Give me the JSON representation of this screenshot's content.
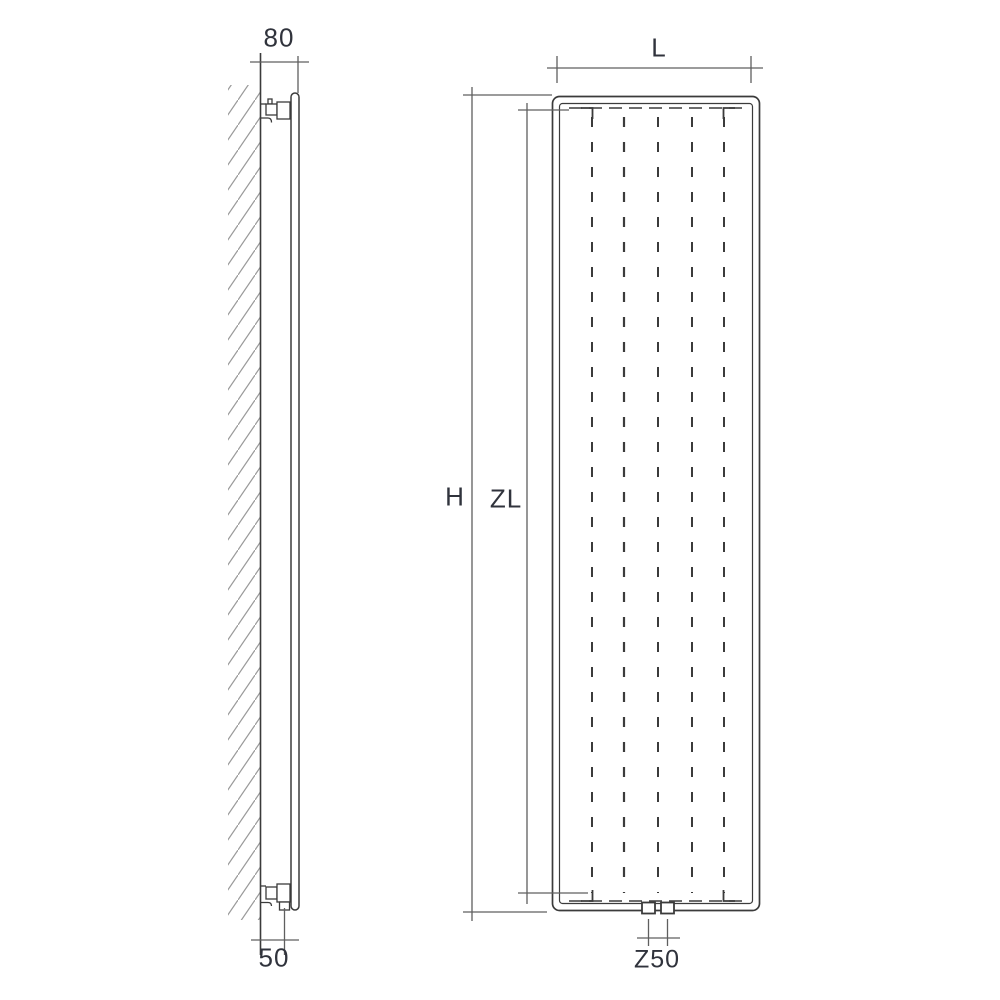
{
  "drawing": {
    "title": "radiator-technical-drawing",
    "labels": {
      "depth_top": "80",
      "offset_bottom": "50",
      "width": "L",
      "height": "H",
      "inner_height": "ZL",
      "connection_spacing": "Z50"
    },
    "colors": {
      "line": "#3b3b3b",
      "dimension_line": "#5f5f5f",
      "hatch": "#9a9a9a",
      "text": "#30333c",
      "background": "#ffffff"
    }
  }
}
